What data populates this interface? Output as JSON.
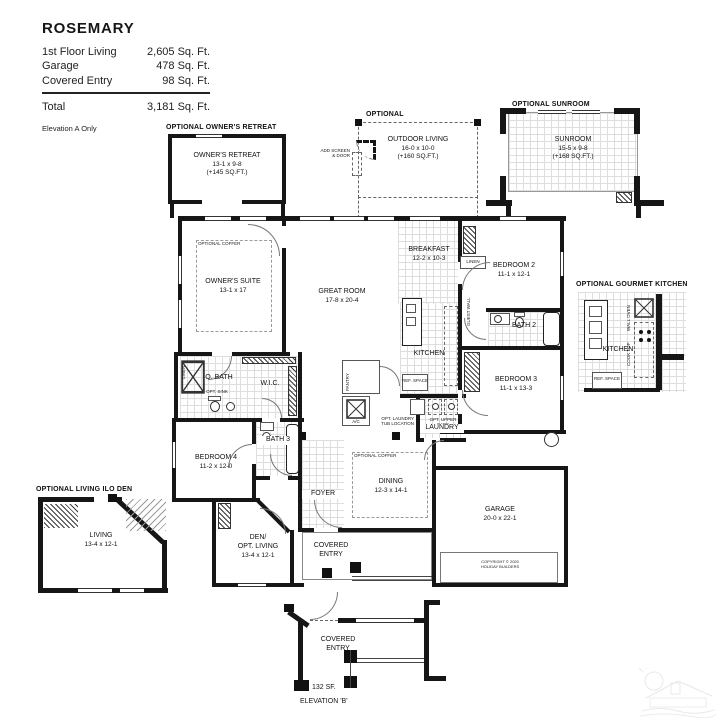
{
  "title_block": {
    "title": "ROSEMARY",
    "rows": [
      {
        "label": "1st Floor Living",
        "value": "2,605 Sq. Ft."
      },
      {
        "label": "Garage",
        "value": "478 Sq. Ft."
      },
      {
        "label": "Covered Entry",
        "value": "98 Sq. Ft."
      }
    ],
    "total_label": "Total",
    "total_value": "3,181 Sq. Ft.",
    "note": "Elevation A Only"
  },
  "optional_owners_retreat": {
    "heading": "OPTIONAL OWNER'S RETREAT",
    "name": "OWNER'S RETREAT",
    "dims": "13-1 x 9-8",
    "area": "(+145 SQ.FT.)"
  },
  "optional_outdoor_living": {
    "heading": "OPTIONAL",
    "name": "OUTDOOR LIVING",
    "dims": "16-0 x 10-0",
    "area": "(+160 SQ.FT.)",
    "note_line1": "ADD SCREEN",
    "note_line2": "& DOOR"
  },
  "optional_sunroom": {
    "heading": "OPTIONAL SUNROOM",
    "name": "SUNROOM",
    "dims": "15-5 x 9-8",
    "area": "(+168 SQ.FT.)"
  },
  "optional_gourmet_kitchen": {
    "heading": "OPTIONAL GOURMET KITCHEN",
    "name": "KITCHEN",
    "wall_oven": "WALL OVEN",
    "cook_top": "COOK TOP",
    "ref_space": "REF. SPACE"
  },
  "optional_living": {
    "heading": "OPTIONAL LIVING ILO DEN",
    "name": "LIVING",
    "dims": "13-4 x 12-1"
  },
  "elevation_b": {
    "name": "COVERED ENTRY",
    "area": "132 SF.",
    "caption": "ELEVATION 'B'"
  },
  "rooms": {
    "owners_suite": {
      "name": "OWNER'S SUITE",
      "dims": "13-1 x 17"
    },
    "great_room": {
      "name": "GREAT ROOM",
      "dims": "17-8 x 20-4"
    },
    "breakfast": {
      "name": "BREAKFAST",
      "dims": "12-2 x 10-3"
    },
    "bedroom2": {
      "name": "BEDROOM 2",
      "dims": "11-1 x 12-1"
    },
    "bath2": {
      "name": "BATH 2"
    },
    "kitchen": {
      "name": "KITCHEN"
    },
    "bedroom3": {
      "name": "BEDROOM 3",
      "dims": "11-1 x 13-3"
    },
    "owners_bath": {
      "name": "O. BATH"
    },
    "wic": {
      "name": "W.I.C."
    },
    "bedroom4": {
      "name": "BEDROOM 4",
      "dims": "11-2 x 12-0"
    },
    "bath3": {
      "name": "BATH 3"
    },
    "laundry": {
      "name": "LAUNDRY"
    },
    "dining": {
      "name": "DINING",
      "dims": "12-3 x 14-1"
    },
    "foyer": {
      "name": "FOYER"
    },
    "den": {
      "line1": "DEN/",
      "line2": "OPT. LIVING",
      "dims": "13-4 x 12-1"
    },
    "covered_entry": {
      "name": "COVERED ENTRY"
    },
    "garage": {
      "name": "GARAGE",
      "dims": "20-0 x 22-1"
    }
  },
  "annotations": {
    "optional_coffer": "OPTIONAL COFFER",
    "linen": "LINEN",
    "guest_wall": "GUEST WALL",
    "pantry": "PANTRY",
    "ac": "A/C",
    "ref_space": "REF. SPACE",
    "opt_sink": "OPT. SINK",
    "opt_laundry_tub_1": "OPT. LAUNDRY",
    "opt_laundry_tub_2": "TUB LOCATION",
    "opt_upper_cabs": "OPT. UPPER CABS",
    "copyright_1": "COPYRIGHT © 2020",
    "copyright_2": "HOLIDAY BUILDERS"
  }
}
